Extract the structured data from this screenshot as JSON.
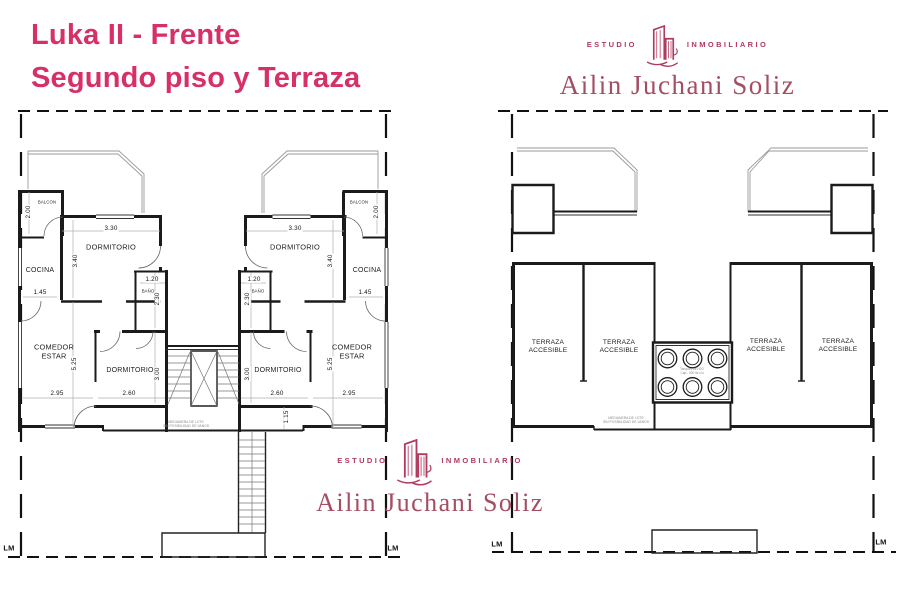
{
  "title": {
    "line1": "Luka II - Frente",
    "line2": "Segundo piso y Terraza"
  },
  "brand": {
    "studio_left": "ESTUDIO",
    "studio_right": "INMOBILIARIO",
    "owner": "Ailin Juchani Soliz"
  },
  "colors": {
    "title_pink": "#d63066",
    "brand_rose": "#b13a5f",
    "brand_name": "#a34e63",
    "ink": "#1b1b1b"
  },
  "floor_plan": {
    "rooms": {
      "balcon": "BALCON",
      "dormitorio": "DORMITORIO",
      "cocina": "COCINA",
      "bano": "BAÑO",
      "comedor": "COMEDOR\nESTAR"
    },
    "dims": {
      "d200": "2.00",
      "d330": "3.30",
      "d340": "3.40",
      "d145": "1.45",
      "d120": "1.20",
      "d230": "2.30",
      "d525": "5.25",
      "d295": "2.95",
      "d260": "2.60",
      "d300": "3.00",
      "d115": "1.15"
    },
    "note": "MEDIANERA DE LOTE\nSIN POSIBILIDAD DE VANOS",
    "boundary": "LM"
  },
  "terrace_plan": {
    "rooms": {
      "terraza": "TERRAZA\nACCESIBLE"
    },
    "tank_note": "Tanques de H2O\nCap.: 500 lts c/u",
    "note": "MEDIANERA DE LOTE\nSIN POSIBILIDAD DE VANOS",
    "boundary": "LM"
  }
}
